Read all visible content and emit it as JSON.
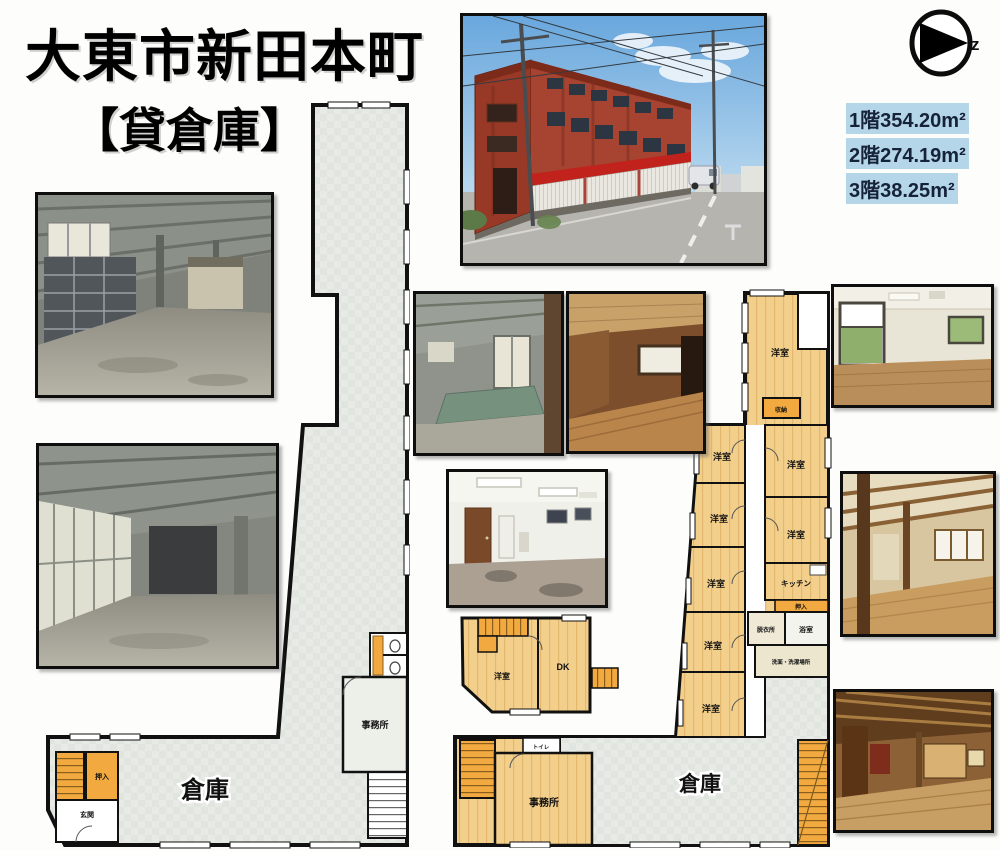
{
  "title": {
    "line1": "大東市新田本町",
    "line2": "【貸倉庫】"
  },
  "north_mark": "z",
  "floor_areas": [
    {
      "floor": "1階",
      "value": "354.20",
      "unit": "m²"
    },
    {
      "floor": "2階",
      "value": "274.19",
      "unit": "m²"
    },
    {
      "floor": "3階",
      "value": "38.25",
      "unit": "m²"
    }
  ],
  "plan_labels": {
    "warehouse": "倉庫",
    "office": "事務所",
    "western_room": "洋室",
    "dining_kitchen": "DK",
    "kitchen": "キッチン",
    "storage": "収納",
    "closet": "押入",
    "dressing_room": "脱衣所",
    "bath": "浴室",
    "laundry": "洗面・洗濯場所",
    "toilet": "トイレ",
    "entrance": "玄関"
  }
}
